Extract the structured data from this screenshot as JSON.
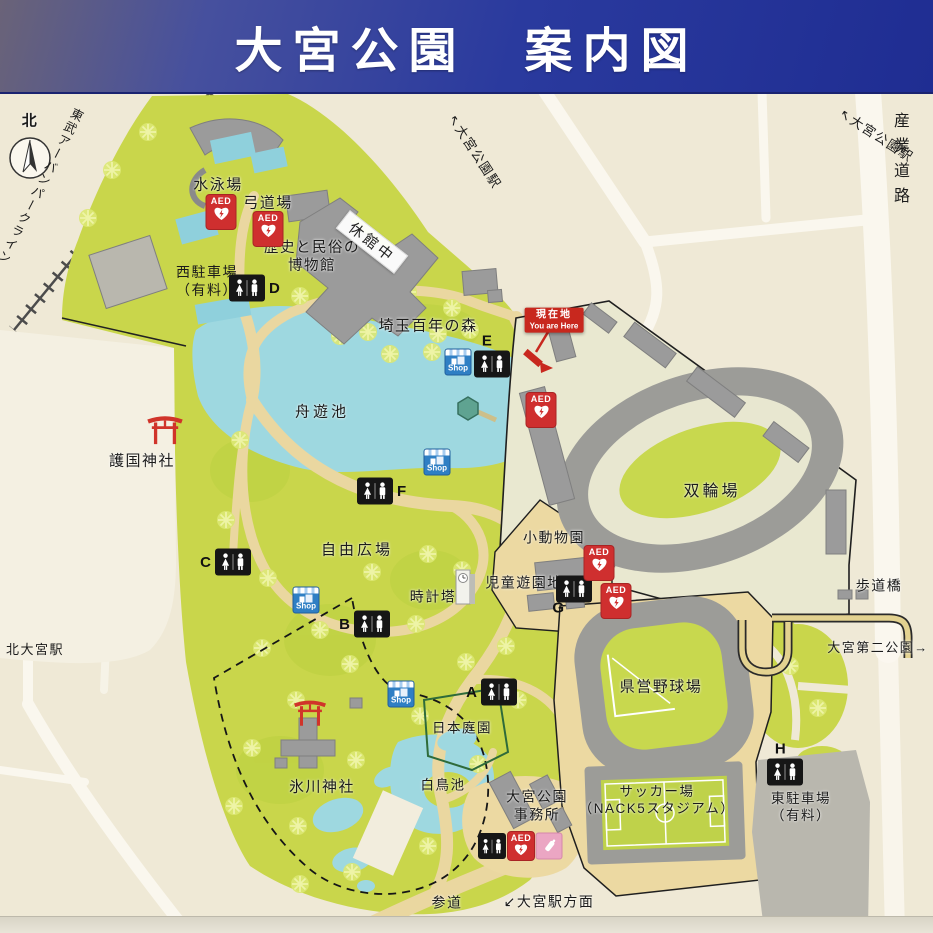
{
  "title": "大宮公園　案内図",
  "compass": {
    "north": "北"
  },
  "railway": {
    "name": "東武アーバンパークライン"
  },
  "stations": {
    "omiya_koen_upper": "↖大宮公園駅",
    "omiya_koen_corner": "↖大宮公園駅",
    "kita_omiya": "北大宮駅"
  },
  "roads": {
    "sangyo": "産業道路",
    "pedestrian_bridge": "歩道橋",
    "daini_park": "大宮第二公園→",
    "sando": "参道",
    "to_omiya_station": "↙大宮駅方面"
  },
  "facilities": {
    "swimming": "水泳場",
    "archery": "弓道場",
    "museum_l1": "歴史と民俗の",
    "museum_l2": "博物館",
    "closed_banner": "休館中",
    "west_parking_l1": "西駐車場",
    "west_parking_l2": "（有料）",
    "forest": "埼玉百年の森",
    "boat_pond": "舟遊池",
    "gokoku_shrine": "護国神社",
    "free_plaza": "自由広場",
    "clock_tower": "時計塔",
    "small_zoo": "小動物園",
    "children_park": "児童遊園地",
    "velodrome": "双輪場",
    "baseball": "県営野球場",
    "soccer_l1": "サッカー場",
    "soccer_l2": "（NACK5スタジアム）",
    "east_parking_l1": "東駐車場",
    "east_parking_l2": "（有料）",
    "hikawa_shrine": "氷川神社",
    "swan_pond": "白鳥池",
    "japanese_garden": "日本庭園",
    "office_l1": "大宮公園",
    "office_l2": "事務所"
  },
  "icons": {
    "aed": "AED",
    "shop": "Shop",
    "you_are_here_jp": "現在地",
    "you_are_here_en": "You are Here"
  },
  "toilets": {
    "a": "A",
    "b": "B",
    "c": "C",
    "d": "D",
    "e": "E",
    "f": "F",
    "g": "G",
    "h": "H"
  },
  "colors": {
    "banner_blue": "#25339a",
    "park_green": "#c9d64b",
    "water_blue": "#9ed8e0",
    "aed_red": "#cf2f2f",
    "shop_blue": "#2f7fc4",
    "torii_red": "#d0342a"
  }
}
